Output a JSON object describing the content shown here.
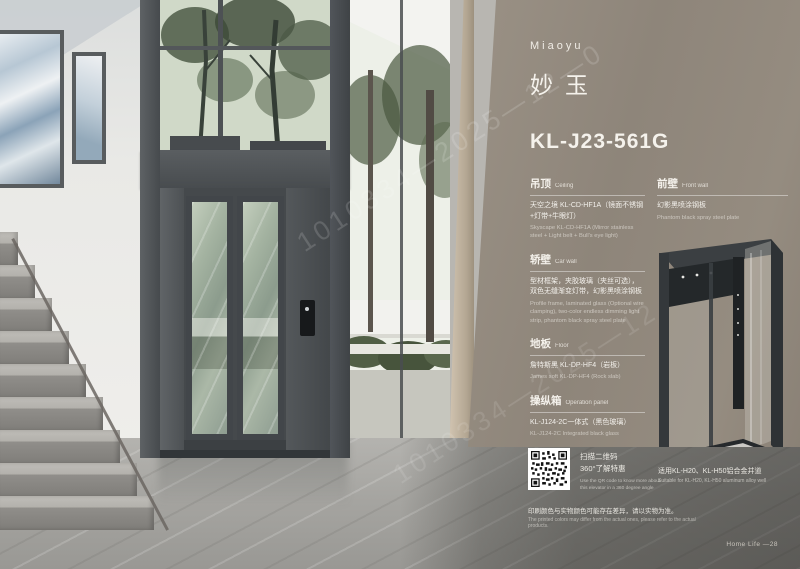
{
  "watermark": {
    "line1": "1010334—2025—12—0",
    "line2": "1010334—2025—12"
  },
  "panel": {
    "brand": "Miaoyu",
    "product_name_cn": "妙玉",
    "model": "KL-J23-561G",
    "specs_left": [
      {
        "title_cn": "吊顶",
        "title_en": "Ceiling",
        "detail_cn": "天空之境 KL-CD-HF1A（镜面不锈钢+灯带+牛眼灯）",
        "detail_en": "Skyscape KL-CD-HF1A (Mirror stainless steel + Light belt + Bull's eye light)"
      },
      {
        "title_cn": "轿壁",
        "title_en": "Car wall",
        "detail_cn": "型材框架，夹胶玻璃（夹丝可选），双色无缝渐变灯带，幻影黑喷涂钢板",
        "detail_en": "Profile frame, laminated glass (Optional wire clamping), two-color endless dimming light strip, phantom black spray steel plate"
      },
      {
        "title_cn": "地板",
        "title_en": "Floor",
        "detail_cn": "詹特斯黑 KL-DP-HF4（岩板）",
        "detail_en": "James soft KL-DP-HF4 (Rock slab)"
      },
      {
        "title_cn": "操纵箱",
        "title_en": "Operation panel",
        "detail_cn": "KL-J124-2C一体式（黑色玻璃）",
        "detail_en": "KL-J124-2C Integrated black glass"
      },
      {
        "title_cn": "扶手",
        "title_en": "Handrail",
        "detail_cn": "可选配",
        "detail_en": "Optional"
      },
      {
        "title_cn": "轿门",
        "title_en": "Car door",
        "detail_cn": "型材框架，夹胶玻璃",
        "detail_en": "Profile frame, laminated glass"
      }
    ],
    "specs_right": [
      {
        "title_cn": "前壁",
        "title_en": "Front wall",
        "detail_cn": "幻影黑喷涂钢板",
        "detail_en": "Phantom black spray steel plate"
      }
    ]
  },
  "footer": {
    "qr_caption_cn_1": "扫描二维码",
    "qr_caption_cn_2": "360°了解特惠",
    "qr_caption_en": "Use the QR code to know more about this elevator in a 360 degree angle",
    "suitable_cn": "适用KL-H20、KL-H50铝合金井道",
    "suitable_en": "Suitable for KL-H20, KL-H50 aluminum alloy well",
    "note_cn": "印刷颜色与实物颜色可能存在差异，请以实物为准。",
    "note_en": "The printed colors may differ from the actual ones, please refer to the actual products.",
    "page_label": "Home Life —28"
  },
  "colors": {
    "panel_bg": "#8f8679",
    "frame_dark": "#4b4f52",
    "text_light": "#f5f2ec"
  }
}
